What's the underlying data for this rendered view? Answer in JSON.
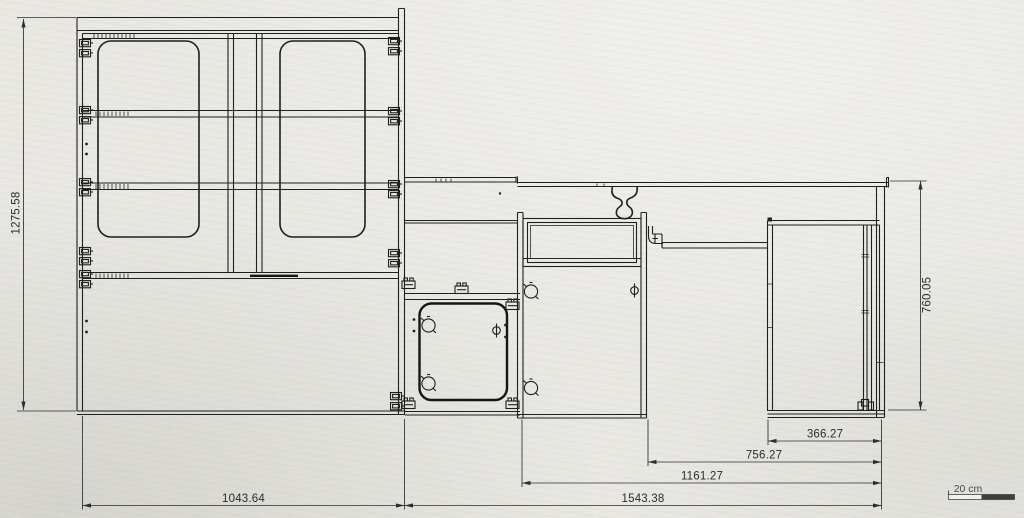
{
  "dimensions": {
    "left_height": "1275.58",
    "right_height": "760.05",
    "bottom_left_width": "1043.64",
    "bottom_total_width": "1543.38",
    "bottom_mid_width": "1161.27",
    "bottom_inner_width": "756.27",
    "bottom_desk_width": "366.27"
  },
  "scale_bar": {
    "label": "20 cm"
  },
  "colors": {
    "paper": "#e9e8e3",
    "line": "#1f1f1f",
    "dimension": "#2e2e2e",
    "scale_fill": "#3f3f3f"
  }
}
